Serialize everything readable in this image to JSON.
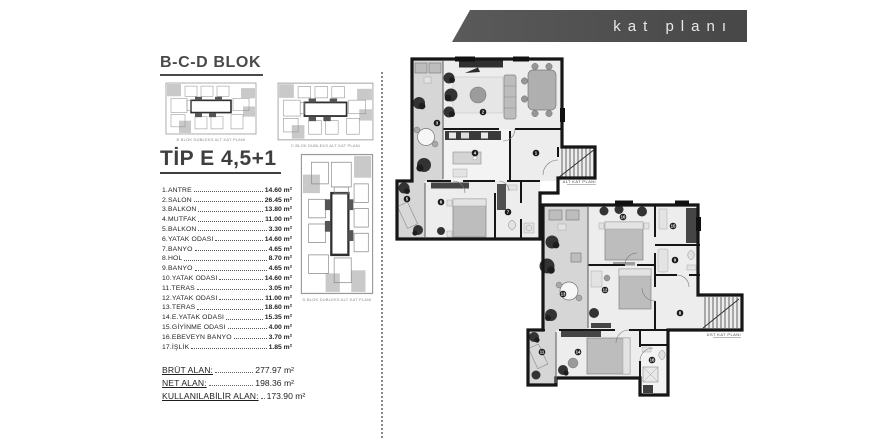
{
  "header": {
    "title": "kat planı"
  },
  "sidebar": {
    "block_title": "B-C-D BLOK",
    "type_title": "TİP E 4,5+1",
    "thumbnails": [
      {
        "caption": "B BLOK DUBLEKS ALT KAT PLANI"
      },
      {
        "caption": "C BLOK DUBLEKS ALT KAT PLANI"
      },
      {
        "caption": "D BLOK DUBLEKS ALT KAT PLANI"
      }
    ],
    "rooms": [
      {
        "label": "1.ANTRE",
        "area": "14.60 m²"
      },
      {
        "label": "2.SALON",
        "area": "26.45 m²"
      },
      {
        "label": "3.BALKON",
        "area": "13.80 m²"
      },
      {
        "label": "4.MUTFAK",
        "area": "11.00 m²"
      },
      {
        "label": "5.BALKON",
        "area": "3.30 m²"
      },
      {
        "label": "6.YATAK ODASI",
        "area": "14.60 m²"
      },
      {
        "label": "7.BANYO",
        "area": "4.65 m²"
      },
      {
        "label": "8.HOL",
        "area": "8.70 m²"
      },
      {
        "label": "9.BANYO",
        "area": "4.65 m²"
      },
      {
        "label": "10.YATAK ODASI",
        "area": "14.60 m²"
      },
      {
        "label": "11.TERAS",
        "area": "3.05 m²"
      },
      {
        "label": "12.YATAK ODASI",
        "area": "11.00 m²"
      },
      {
        "label": "13.TERAS",
        "area": "18.60 m²"
      },
      {
        "label": "14.E.YATAK ODASI",
        "area": "15.35 m²"
      },
      {
        "label": "15.GİYİNME ODASI",
        "area": "4.00 m²"
      },
      {
        "label": "16.EBEVEYN BANYO",
        "area": "3.70 m²"
      },
      {
        "label": "17.İŞLİK",
        "area": "1.85 m²"
      }
    ],
    "totals": [
      {
        "label": "BRÜT ALAN:",
        "value": "277.97 m²"
      },
      {
        "label": "NET ALAN:",
        "value": "198.36 m²"
      },
      {
        "label": "KULLANILABİLİR ALAN:",
        "value": "173.90 m²"
      }
    ]
  },
  "plans": {
    "lower": {
      "caption": "ALT KAT PLANI",
      "numbers": [
        "1",
        "2",
        "3",
        "4",
        "5",
        "6",
        "7"
      ]
    },
    "upper": {
      "caption": "ÜST KAT PLANI",
      "numbers": [
        "8",
        "9",
        "10",
        "11",
        "12",
        "13",
        "14",
        "15",
        "16"
      ]
    }
  },
  "colors": {
    "header_bar": "#4b4b4b",
    "wall": "#161616",
    "floor": "#ededed",
    "balcony_floor": "#d6d6d6",
    "accent_text": "#454545"
  }
}
